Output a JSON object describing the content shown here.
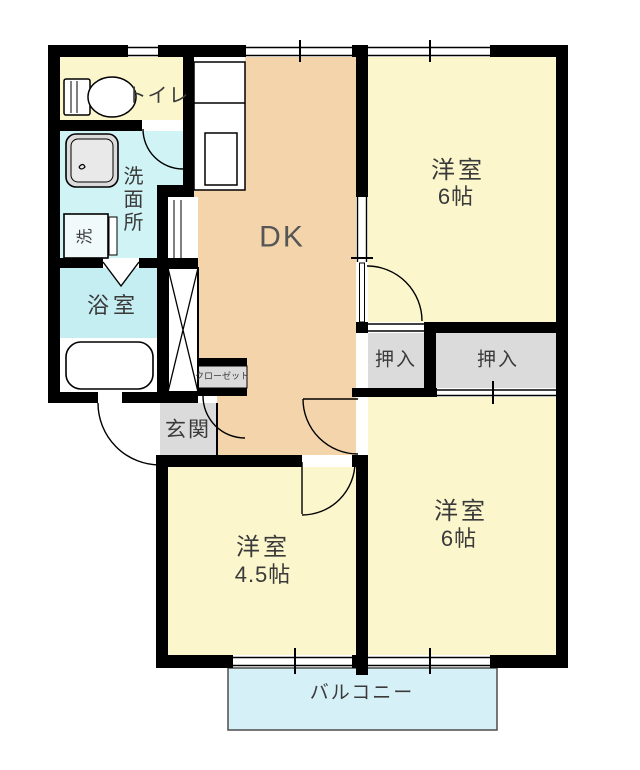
{
  "rooms": {
    "dk": {
      "label": "DK"
    },
    "bedroom_top_right": {
      "label": "洋室",
      "size": "6帖"
    },
    "bedroom_bottom_right": {
      "label": "洋室",
      "size": "6帖"
    },
    "bedroom_bottom_left": {
      "label": "洋室",
      "size": "4.5帖"
    },
    "toilet": {
      "label": "トイレ"
    },
    "washroom": {
      "label": "洗面所"
    },
    "laundry": {
      "label": "洗"
    },
    "bathroom": {
      "label": "浴室"
    },
    "entrance": {
      "label": "玄関"
    },
    "closet": {
      "label": "クローゼット"
    },
    "oshiire_small": {
      "label": "押入"
    },
    "oshiire_large": {
      "label": "押入"
    },
    "balcony": {
      "label": "バルコニー"
    }
  },
  "colors": {
    "wall": "#000000",
    "dk_floor": "#F4D5AB",
    "bedroom_floor": "#FBF6CC",
    "washroom_floor": "#D0F3F5",
    "bathroom_floor": "#C5EEF2",
    "balcony_floor": "#D6F0F8",
    "storage_gray": "#DBDBDB",
    "label_text": "#3A3A3A"
  }
}
